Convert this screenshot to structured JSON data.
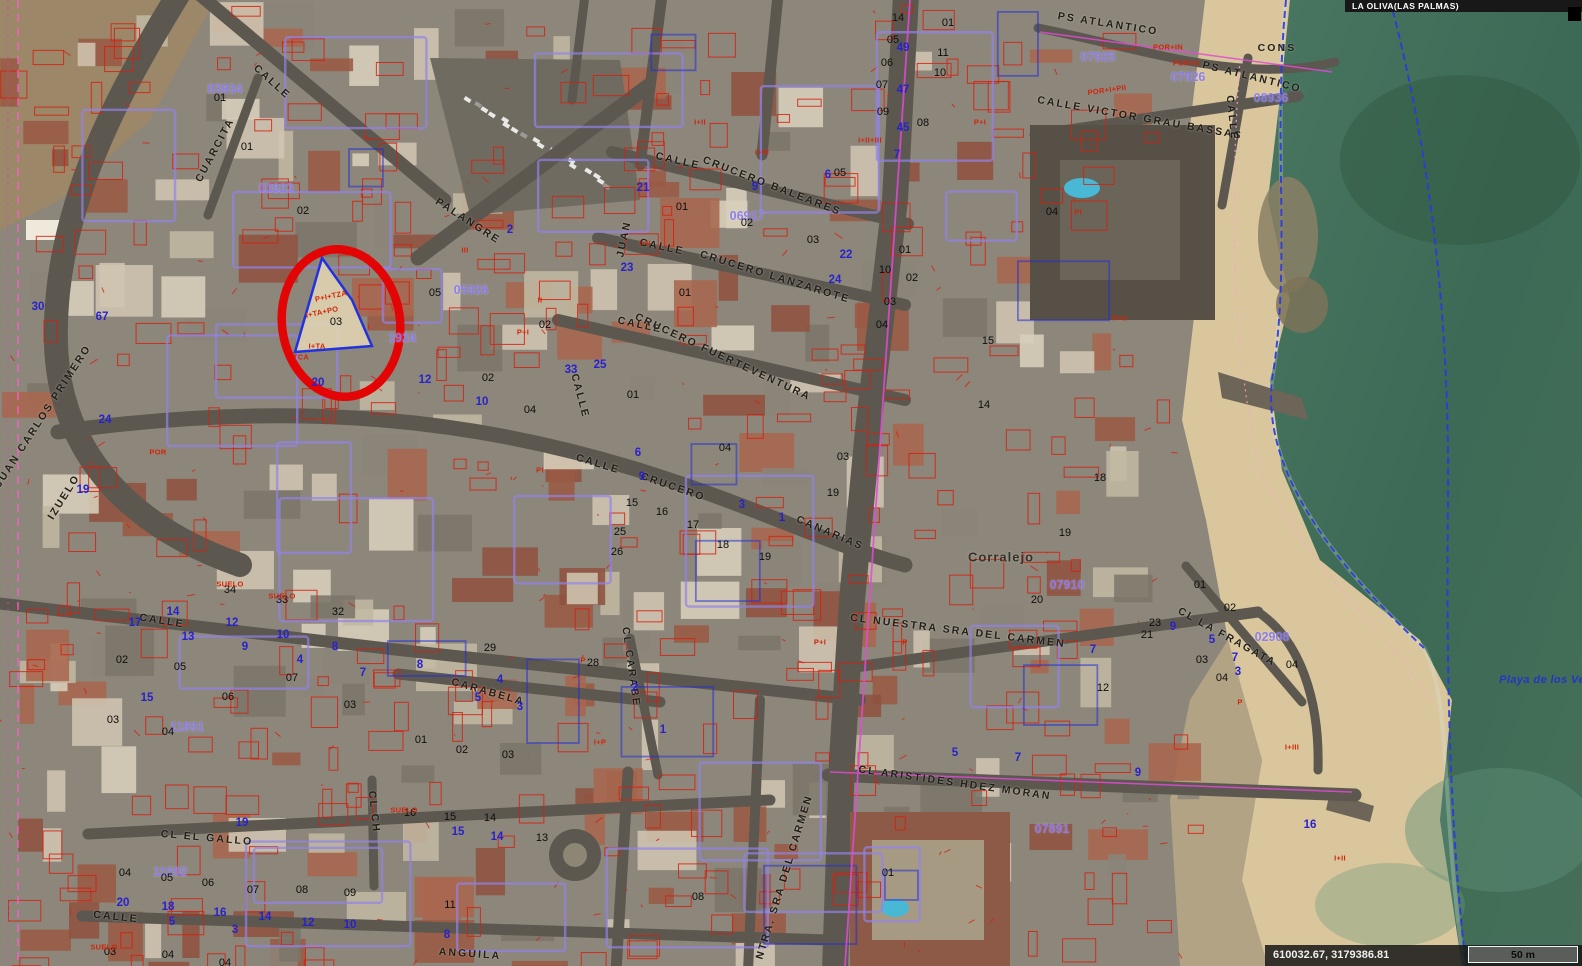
{
  "header": {
    "municipality": "LA OLIVA(LAS PALMAS)"
  },
  "statusbar": {
    "coordinates": "610032.67, 3179386.81",
    "scale_label": "50 m"
  },
  "annotation": {
    "type": "red-circle",
    "cx": 341,
    "cy": 323,
    "rx": 59,
    "ry": 74,
    "rot": -8,
    "stroke_width": 8.5,
    "color": "#e30505"
  },
  "colors": {
    "ocean": "#3c6a56",
    "sand": "#d9c69c",
    "urban_ground": "#8d867a",
    "road": "#5c5850",
    "cadastral_red": "#d6200e",
    "parcel_purple": "#9183ea",
    "code_purple": "#8a7cf0",
    "house_number_blue": "#2822cc",
    "coastline_blue": "#2a3ae0",
    "magenta": "#e04ad6",
    "street_text": "#221f1a",
    "annotation_red": "#e30505"
  },
  "map": {
    "place_labels": [
      [
        "Corralejo",
        1001,
        557,
        0
      ]
    ],
    "sea_labels": [
      [
        "Playa de los Ve",
        1542,
        680,
        0
      ]
    ],
    "street_labels": [
      [
        "PS ATLANTICO",
        1108,
        24,
        9
      ],
      [
        "PS ATLANTICO",
        1252,
        77,
        14
      ],
      [
        "CALLE VICTOR GRAU BASSAS",
        1140,
        118,
        10
      ],
      [
        "CALLE",
        1232,
        118,
        84
      ],
      [
        "CONS",
        1277,
        48,
        0
      ],
      [
        "CALLE",
        272,
        82,
        42
      ],
      [
        "CUARCITA",
        215,
        150,
        -62
      ],
      [
        "PALANGRE",
        468,
        221,
        33
      ],
      [
        "CALLE",
        678,
        161,
        13
      ],
      [
        "CRUCERO BALEARES",
        772,
        186,
        21
      ],
      [
        "CALLE",
        662,
        247,
        12
      ],
      [
        "CRUCERO LANZAROTE",
        775,
        277,
        17
      ],
      [
        "CALLE",
        640,
        325,
        12
      ],
      [
        "CRUCERO FUERTEVENTURA",
        723,
        357,
        25
      ],
      [
        "JUAN",
        624,
        239,
        -78
      ],
      [
        "CALLE",
        598,
        464,
        17
      ],
      [
        "CRUCERO",
        673,
        487,
        19
      ],
      [
        "CANARIAS",
        830,
        533,
        23
      ],
      [
        "CALLE",
        580,
        396,
        75
      ],
      [
        "CL NUESTRA SRA DEL CARMEN",
        958,
        631,
        7
      ],
      [
        "CL LA FRAGATA",
        1227,
        637,
        29
      ],
      [
        "CL ARISTIDES HDEZ MORAN",
        955,
        783,
        8
      ],
      [
        "CL NTRA. SRA DEL CARMEN",
        781,
        888,
        -73
      ],
      [
        "CALLE",
        162,
        621,
        9
      ],
      [
        "CARABELA",
        488,
        692,
        16
      ],
      [
        "CL CARABE",
        631,
        667,
        82
      ],
      [
        "CL EL GALLO",
        207,
        838,
        5
      ],
      [
        "CALLE",
        116,
        917,
        6
      ],
      [
        "ANGUILA",
        470,
        954,
        4
      ],
      [
        "JUAN CARLOS PRIMERO",
        43,
        416,
        -57
      ],
      [
        "IZUELO",
        64,
        497,
        -58
      ],
      [
        "CL CH",
        374,
        812,
        84
      ]
    ],
    "parcel_codes": [
      [
        "03934",
        225,
        89,
        0
      ],
      [
        "03923",
        276,
        188,
        0
      ],
      [
        "05926",
        471,
        290,
        0
      ],
      [
        "06917",
        747,
        216,
        0
      ],
      [
        "07925",
        1098,
        57,
        0
      ],
      [
        "07926",
        1188,
        77,
        0
      ],
      [
        "08936",
        1271,
        98,
        0
      ],
      [
        "07910",
        1067,
        585,
        0
      ],
      [
        "07891",
        1052,
        829,
        0
      ],
      [
        "02908",
        1272,
        637,
        0
      ],
      [
        "11891",
        187,
        727,
        0
      ],
      [
        "11092",
        170,
        872,
        0
      ],
      [
        "1924",
        402,
        338,
        0
      ]
    ],
    "parcel_numbers": [
      [
        "01",
        220,
        98
      ],
      [
        "01",
        247,
        147
      ],
      [
        "02",
        303,
        211
      ],
      [
        "03",
        336,
        322
      ],
      [
        "05",
        435,
        293
      ],
      [
        "02",
        545,
        325
      ],
      [
        "02",
        488,
        378
      ],
      [
        "04",
        530,
        410
      ],
      [
        "01",
        633,
        395
      ],
      [
        "01",
        685,
        293
      ],
      [
        "01",
        682,
        207
      ],
      [
        "02",
        747,
        223
      ],
      [
        "03",
        813,
        240
      ],
      [
        "05",
        840,
        173
      ],
      [
        "10",
        885,
        270
      ],
      [
        "02",
        912,
        278
      ],
      [
        "03",
        890,
        302
      ],
      [
        "04",
        882,
        325
      ],
      [
        "01",
        905,
        250
      ],
      [
        "02",
        122,
        660
      ],
      [
        "05",
        180,
        667
      ],
      [
        "06",
        228,
        697
      ],
      [
        "07",
        292,
        678
      ],
      [
        "03",
        350,
        705
      ],
      [
        "03",
        113,
        720
      ],
      [
        "04",
        168,
        732
      ],
      [
        "32",
        338,
        612
      ],
      [
        "34",
        230,
        590
      ],
      [
        "33",
        282,
        600
      ],
      [
        "01",
        421,
        740
      ],
      [
        "02",
        462,
        750
      ],
      [
        "03",
        508,
        755
      ],
      [
        "28",
        593,
        663
      ],
      [
        "29",
        490,
        648
      ],
      [
        "04",
        725,
        448
      ],
      [
        "15",
        632,
        503
      ],
      [
        "16",
        662,
        512
      ],
      [
        "17",
        693,
        525
      ],
      [
        "18",
        723,
        545
      ],
      [
        "19",
        765,
        557
      ],
      [
        "25",
        620,
        532
      ],
      [
        "26",
        617,
        552
      ],
      [
        "03",
        843,
        457
      ],
      [
        "19",
        833,
        493
      ],
      [
        "20",
        1037,
        600
      ],
      [
        "23",
        1155,
        623
      ],
      [
        "21",
        1147,
        635
      ],
      [
        "01",
        1200,
        585
      ],
      [
        "02",
        1230,
        608
      ],
      [
        "03",
        1202,
        660
      ],
      [
        "04",
        1222,
        678
      ],
      [
        "04",
        1292,
        665
      ],
      [
        "19",
        1065,
        533
      ],
      [
        "04",
        1052,
        212
      ],
      [
        "15",
        988,
        341
      ],
      [
        "14",
        984,
        405
      ],
      [
        "18",
        1100,
        478
      ],
      [
        "12",
        1103,
        688
      ],
      [
        "04",
        125,
        873
      ],
      [
        "05",
        167,
        878
      ],
      [
        "06",
        208,
        883
      ],
      [
        "07",
        253,
        890
      ],
      [
        "08",
        302,
        890
      ],
      [
        "09",
        350,
        893
      ],
      [
        "11",
        450,
        905
      ],
      [
        "03",
        110,
        952
      ],
      [
        "04",
        168,
        955
      ],
      [
        "04",
        225,
        963
      ],
      [
        "15",
        450,
        817
      ],
      [
        "16",
        410,
        813
      ],
      [
        "14",
        490,
        818
      ],
      [
        "13",
        542,
        838
      ],
      [
        "01",
        888,
        873
      ],
      [
        "08",
        698,
        897
      ],
      [
        "14",
        898,
        18
      ],
      [
        "05",
        893,
        40
      ],
      [
        "06",
        887,
        63
      ],
      [
        "07",
        882,
        85
      ],
      [
        "09",
        883,
        112
      ],
      [
        "10",
        940,
        73
      ],
      [
        "11",
        943,
        53
      ],
      [
        "08",
        923,
        123
      ],
      [
        "01",
        948,
        23
      ]
    ],
    "house_numbers": [
      [
        "30",
        38,
        307
      ],
      [
        "67",
        102,
        317
      ],
      [
        "24",
        105,
        420
      ],
      [
        "19",
        83,
        490
      ],
      [
        "17",
        135,
        623
      ],
      [
        "14",
        173,
        612
      ],
      [
        "13",
        188,
        637
      ],
      [
        "12",
        232,
        623
      ],
      [
        "10",
        283,
        635
      ],
      [
        "9",
        245,
        647
      ],
      [
        "8",
        335,
        647
      ],
      [
        "4",
        300,
        660
      ],
      [
        "7",
        363,
        673
      ],
      [
        "15",
        147,
        698
      ],
      [
        "8",
        420,
        665
      ],
      [
        "4",
        500,
        680
      ],
      [
        "5",
        478,
        698
      ],
      [
        "3",
        520,
        707
      ],
      [
        "2",
        635,
        688
      ],
      [
        "1",
        663,
        730
      ],
      [
        "6",
        638,
        453
      ],
      [
        "9",
        642,
        477
      ],
      [
        "3",
        742,
        505
      ],
      [
        "1",
        782,
        518
      ],
      [
        "23",
        627,
        268
      ],
      [
        "25",
        600,
        365
      ],
      [
        "33",
        571,
        370
      ],
      [
        "10",
        482,
        402
      ],
      [
        "12",
        425,
        380
      ],
      [
        "20",
        318,
        383
      ],
      [
        "21",
        643,
        188
      ],
      [
        "9",
        755,
        187
      ],
      [
        "6",
        828,
        175
      ],
      [
        "22",
        846,
        255
      ],
      [
        "24",
        835,
        280
      ],
      [
        "7",
        897,
        155
      ],
      [
        "20",
        123,
        903
      ],
      [
        "18",
        168,
        907
      ],
      [
        "16",
        220,
        913
      ],
      [
        "14",
        265,
        917
      ],
      [
        "12",
        308,
        923
      ],
      [
        "10",
        350,
        925
      ],
      [
        "8",
        447,
        935
      ],
      [
        "5",
        172,
        922
      ],
      [
        "3",
        235,
        930
      ],
      [
        "19",
        242,
        823
      ],
      [
        "15",
        458,
        832
      ],
      [
        "14",
        497,
        837
      ],
      [
        "5",
        955,
        753
      ],
      [
        "7",
        1018,
        758
      ],
      [
        "9",
        1138,
        773
      ],
      [
        "9",
        1173,
        627
      ],
      [
        "5",
        1212,
        640
      ],
      [
        "7",
        1235,
        658
      ],
      [
        "7",
        1093,
        650
      ],
      [
        "49",
        903,
        48
      ],
      [
        "47",
        903,
        90
      ],
      [
        "45",
        903,
        128
      ],
      [
        "2",
        510,
        230
      ],
      [
        "16",
        1310,
        825
      ],
      [
        "3",
        1238,
        672
      ]
    ],
    "subparcel_texts": [
      [
        "POR+I+PII",
        1107,
        90,
        -8
      ],
      [
        "POR+II",
        1186,
        63,
        0
      ],
      [
        "POR+IN",
        1168,
        47,
        0
      ],
      [
        "P+I+TZA",
        331,
        296,
        -12
      ],
      [
        "I+TA+PO",
        322,
        312,
        -12
      ],
      [
        "I+TA",
        317,
        346,
        0
      ],
      [
        "TCA",
        301,
        357,
        0
      ],
      [
        "SUELO",
        230,
        584,
        0
      ],
      [
        "SUELO",
        282,
        596,
        0
      ],
      [
        "SUELO",
        104,
        947,
        0
      ],
      [
        "SUELO",
        404,
        810,
        0
      ],
      [
        "I+II",
        700,
        122,
        0
      ],
      [
        "I+III",
        762,
        152,
        0
      ],
      [
        "I+II",
        645,
        243,
        0
      ],
      [
        "II",
        540,
        300,
        0
      ],
      [
        "III",
        465,
        250,
        0
      ],
      [
        "P+I",
        523,
        332,
        0
      ],
      [
        "PI",
        540,
        470,
        0
      ],
      [
        "P+I",
        980,
        122,
        0
      ],
      [
        "I+II",
        1340,
        858,
        0
      ],
      [
        "I+III",
        1292,
        747,
        0
      ],
      [
        "P+I",
        820,
        642,
        0
      ],
      [
        "I+P",
        600,
        742,
        0
      ],
      [
        "P",
        905,
        642,
        0
      ],
      [
        "P",
        1240,
        702,
        0
      ],
      [
        "POR",
        158,
        452,
        0
      ],
      [
        "P+II",
        1120,
        318,
        0
      ],
      [
        "I+II+III",
        870,
        140,
        0
      ],
      [
        "PI",
        1078,
        212,
        0
      ],
      [
        "P",
        583,
        660,
        0
      ]
    ]
  }
}
